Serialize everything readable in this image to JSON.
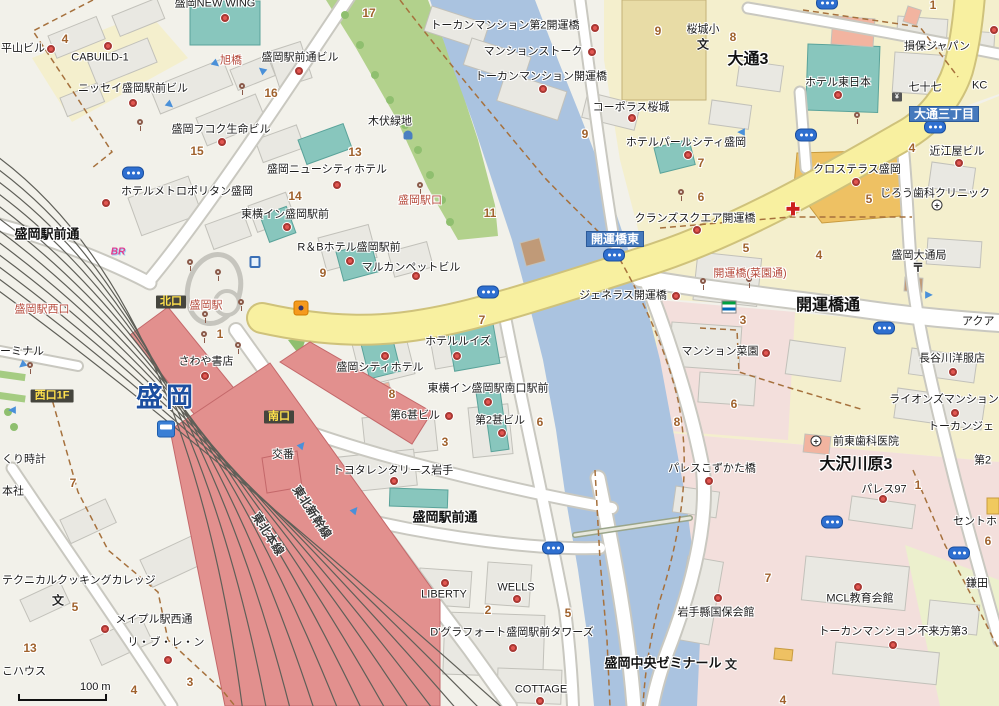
{
  "map": {
    "scale_label": "100 m",
    "colors": {
      "land": "#f2f1ea",
      "building": "#e9e8e2",
      "building_stroke": "#c2c1ba",
      "road_fill": "#ffffff",
      "road_casing": "#c9c8c0",
      "main_road": "#f8f0a0",
      "main_road_casing": "#d3c579",
      "river": "#aac3e0",
      "park": "#b2d18c",
      "district_yellow": "#f4efcd",
      "district_pink": "#f3dfdc",
      "district_green": "#ecf0cd",
      "teal_building": "#88c6bd",
      "orange_building": "#eec163",
      "salmon_building": "#f2b4a0",
      "school_building": "#e8dca6",
      "station_red": "#e2908e",
      "badge_dark_bg": "#45453d",
      "badge_dark_text": "#ffe14d",
      "badge_blue_bg": "#4579bd",
      "badge_blue_text": "#ffffff",
      "poi_dot": "#e25752",
      "red_label": "#b5493b",
      "number_label": "#a0622d",
      "rail_line": "#5f5f58",
      "boundary_dash": "#a6713d",
      "bus_icon": "#2e6fd0",
      "station_name_blue": "#1d4fa0"
    },
    "labels": [
      {
        "t": "盛岡NEW WING",
        "x": 215,
        "y": 4,
        "c": "b"
      },
      {
        "t": "平山ビル",
        "x": 1,
        "y": 49,
        "c": "b",
        "a": "l"
      },
      {
        "t": "CABUILD-1",
        "x": 100,
        "y": 58,
        "c": "b"
      },
      {
        "t": "ニッセイ盛岡駅前ビル",
        "x": 133,
        "y": 89,
        "c": "b"
      },
      {
        "t": "盛岡フコク生命ビル",
        "x": 221,
        "y": 130,
        "c": "b"
      },
      {
        "t": "盛岡駅前通ビル",
        "x": 300,
        "y": 58,
        "c": "b"
      },
      {
        "t": "旭橋",
        "x": 231,
        "y": 61,
        "c": "rb"
      },
      {
        "t": "ホテルメトロポリタン盛岡",
        "x": 187,
        "y": 192,
        "c": "b"
      },
      {
        "t": "東横イン盛岡駅前",
        "x": 285,
        "y": 215,
        "c": "b"
      },
      {
        "t": "盛岡ニューシティホテル",
        "x": 327,
        "y": 170,
        "c": "b"
      },
      {
        "t": "R＆Bホテル盛岡駅前",
        "x": 349,
        "y": 248,
        "c": "b"
      },
      {
        "t": "マルカンペットビル",
        "x": 411,
        "y": 268,
        "c": "b"
      },
      {
        "t": "ホテルルイズ",
        "x": 458,
        "y": 342,
        "c": "b"
      },
      {
        "t": "盛岡シティホテル",
        "x": 380,
        "y": 368,
        "c": "b"
      },
      {
        "t": "東横イン盛岡駅南口駅前",
        "x": 488,
        "y": 389,
        "c": "b"
      },
      {
        "t": "第6甚ビル",
        "x": 415,
        "y": 416,
        "c": "b"
      },
      {
        "t": "第2甚ビル",
        "x": 500,
        "y": 421,
        "c": "b"
      },
      {
        "t": "トヨタレンタリース岩手",
        "x": 393,
        "y": 471,
        "c": "b"
      },
      {
        "t": "さわや書店",
        "x": 206,
        "y": 362,
        "c": "b"
      },
      {
        "t": "交番",
        "x": 283,
        "y": 455,
        "c": "b"
      },
      {
        "t": "木伏緑地",
        "x": 390,
        "y": 122,
        "c": "b"
      },
      {
        "t": "盛岡駅口",
        "x": 420,
        "y": 201,
        "c": "rb"
      },
      {
        "t": "盛岡駅西口",
        "x": 42,
        "y": 310,
        "c": "rb"
      },
      {
        "t": "盛岡駅",
        "x": 206,
        "y": 306,
        "c": "rb"
      },
      {
        "t": "ーミナル",
        "x": 0,
        "y": 352,
        "c": "b",
        "a": "l"
      },
      {
        "t": "くり時計",
        "x": 2,
        "y": 460,
        "c": "b",
        "a": "l"
      },
      {
        "t": "本社",
        "x": 2,
        "y": 492,
        "c": "b",
        "a": "l"
      },
      {
        "t": "こハウス",
        "x": 2,
        "y": 672,
        "c": "b",
        "a": "l"
      },
      {
        "t": "テクニカルクッキングカレッジ",
        "x": 2,
        "y": 581,
        "c": "b",
        "a": "l"
      },
      {
        "t": "メイプル駅西通",
        "x": 154,
        "y": 620,
        "c": "b"
      },
      {
        "t": "リ・ブ・レ・ン",
        "x": 166,
        "y": 643,
        "c": "b"
      },
      {
        "t": "LIBERTY",
        "x": 444,
        "y": 595,
        "c": "b"
      },
      {
        "t": "WELLS",
        "x": 516,
        "y": 588,
        "c": "b"
      },
      {
        "t": "D'グラフォート盛岡駅前タワーズ",
        "x": 512,
        "y": 633,
        "c": "b"
      },
      {
        "t": "COTTAGE",
        "x": 541,
        "y": 690,
        "c": "b"
      },
      {
        "t": "トーカンマンション第2開運橋",
        "x": 505,
        "y": 26,
        "c": "b"
      },
      {
        "t": "マンションストーク",
        "x": 533,
        "y": 52,
        "c": "b"
      },
      {
        "t": "トーカンマンション開運橋",
        "x": 541,
        "y": 77,
        "c": "b"
      },
      {
        "t": "コーポラス桜城",
        "x": 631,
        "y": 108,
        "c": "b"
      },
      {
        "t": "ホテルパールシティ盛岡",
        "x": 686,
        "y": 143,
        "c": "b"
      },
      {
        "t": "クランズスクエア開運橋",
        "x": 695,
        "y": 219,
        "c": "b"
      },
      {
        "t": "ジェネラス開運橋",
        "x": 623,
        "y": 296,
        "c": "b"
      },
      {
        "t": "桜城小",
        "x": 703,
        "y": 30,
        "c": "b"
      },
      {
        "t": "ホテル東日本",
        "x": 838,
        "y": 83,
        "c": "b"
      },
      {
        "t": "七十七",
        "x": 925,
        "y": 88,
        "c": "b"
      },
      {
        "t": "損保ジャパン",
        "x": 937,
        "y": 47,
        "c": "b"
      },
      {
        "t": "KC",
        "x": 972,
        "y": 86,
        "c": "b",
        "a": "l"
      },
      {
        "t": "近江屋ビル",
        "x": 957,
        "y": 152,
        "c": "b"
      },
      {
        "t": "クロステラス盛岡",
        "x": 857,
        "y": 170,
        "c": "b"
      },
      {
        "t": "じろう歯科クリニック",
        "x": 935,
        "y": 194,
        "c": "b"
      },
      {
        "t": "盛岡大通局",
        "x": 919,
        "y": 256,
        "c": "b"
      },
      {
        "t": "開運橋(菜園通)",
        "x": 750,
        "y": 274,
        "c": "rb"
      },
      {
        "t": "マンション菜園",
        "x": 720,
        "y": 352,
        "c": "b"
      },
      {
        "t": "長谷川洋服店",
        "x": 952,
        "y": 359,
        "c": "b"
      },
      {
        "t": "ライオンズマンション",
        "x": 944,
        "y": 400,
        "c": "b"
      },
      {
        "t": "トーカンジェ",
        "x": 928,
        "y": 427,
        "c": "b",
        "a": "l"
      },
      {
        "t": "アクア",
        "x": 962,
        "y": 322,
        "c": "b",
        "a": "l"
      },
      {
        "t": "前東歯科医院",
        "x": 866,
        "y": 442,
        "c": "b"
      },
      {
        "t": "パレスこずかた橋",
        "x": 712,
        "y": 469,
        "c": "b"
      },
      {
        "t": "パレス97",
        "x": 884,
        "y": 490,
        "c": "b"
      },
      {
        "t": "セントホ",
        "x": 953,
        "y": 522,
        "c": "b",
        "a": "l"
      },
      {
        "t": "鎌田",
        "x": 966,
        "y": 584,
        "c": "b",
        "a": "l"
      },
      {
        "t": "第2",
        "x": 974,
        "y": 461,
        "c": "b",
        "a": "l"
      },
      {
        "t": "岩手縣国保会館",
        "x": 716,
        "y": 613,
        "c": "b"
      },
      {
        "t": "MCL教育会館",
        "x": 860,
        "y": 599,
        "c": "b"
      },
      {
        "t": "トーカンマンション不来方第3",
        "x": 893,
        "y": 632,
        "c": "b"
      },
      {
        "t": "盛岡駅前通",
        "x": 47,
        "y": 234,
        "c": "sb"
      },
      {
        "t": "盛岡駅前通",
        "x": 445,
        "y": 517,
        "c": "sb"
      },
      {
        "t": "開運橋通",
        "x": 828,
        "y": 306,
        "c": "sbl"
      },
      {
        "t": "大通3",
        "x": 748,
        "y": 60,
        "c": "sbl"
      },
      {
        "t": "大沢川原3",
        "x": 856,
        "y": 465,
        "c": "sbl"
      },
      {
        "t": "盛岡中央ゼミナール",
        "x": 663,
        "y": 663,
        "c": "sb"
      },
      {
        "t": "北口",
        "x": 171,
        "y": 302,
        "c": "bd"
      },
      {
        "t": "南口",
        "x": 279,
        "y": 417,
        "c": "bd"
      },
      {
        "t": "西口1F",
        "x": 52,
        "y": 396,
        "c": "bd"
      },
      {
        "t": "開運橋東",
        "x": 615,
        "y": 239,
        "c": "bb"
      },
      {
        "t": "大通三丁目",
        "x": 944,
        "y": 114,
        "c": "bb"
      },
      {
        "t": "盛岡",
        "x": 166,
        "y": 398,
        "c": "st"
      },
      {
        "t": "東北新幹線",
        "x": 312,
        "y": 512,
        "c": "rail",
        "r": 57
      },
      {
        "t": "東北本線",
        "x": 268,
        "y": 534,
        "c": "rail",
        "r": 57
      },
      {
        "t": "4",
        "x": 65,
        "y": 39,
        "c": "n"
      },
      {
        "t": "16",
        "x": 271,
        "y": 93,
        "c": "n"
      },
      {
        "t": "15",
        "x": 197,
        "y": 151,
        "c": "n"
      },
      {
        "t": "14",
        "x": 295,
        "y": 196,
        "c": "n"
      },
      {
        "t": "17",
        "x": 369,
        "y": 13,
        "c": "n"
      },
      {
        "t": "13",
        "x": 355,
        "y": 152,
        "c": "n"
      },
      {
        "t": "9",
        "x": 585,
        "y": 134,
        "c": "n"
      },
      {
        "t": "9",
        "x": 658,
        "y": 31,
        "c": "n"
      },
      {
        "t": "11",
        "x": 490,
        "y": 213,
        "c": "n"
      },
      {
        "t": "9",
        "x": 323,
        "y": 273,
        "c": "n"
      },
      {
        "t": "1",
        "x": 220,
        "y": 334,
        "c": "n"
      },
      {
        "t": "8",
        "x": 733,
        "y": 37,
        "c": "n"
      },
      {
        "t": "7",
        "x": 701,
        "y": 163,
        "c": "n"
      },
      {
        "t": "6",
        "x": 701,
        "y": 197,
        "c": "n"
      },
      {
        "t": "5",
        "x": 746,
        "y": 248,
        "c": "n"
      },
      {
        "t": "4",
        "x": 819,
        "y": 255,
        "c": "n"
      },
      {
        "t": "3",
        "x": 743,
        "y": 320,
        "c": "n"
      },
      {
        "t": "4",
        "x": 912,
        "y": 148,
        "c": "n"
      },
      {
        "t": "5",
        "x": 869,
        "y": 199,
        "c": "n"
      },
      {
        "t": "1",
        "x": 933,
        "y": 5,
        "c": "n"
      },
      {
        "t": "7",
        "x": 482,
        "y": 320,
        "c": "n"
      },
      {
        "t": "8",
        "x": 392,
        "y": 394,
        "c": "n"
      },
      {
        "t": "6",
        "x": 540,
        "y": 422,
        "c": "n"
      },
      {
        "t": "3",
        "x": 445,
        "y": 442,
        "c": "n"
      },
      {
        "t": "2",
        "x": 488,
        "y": 610,
        "c": "n"
      },
      {
        "t": "5",
        "x": 568,
        "y": 613,
        "c": "n"
      },
      {
        "t": "7",
        "x": 73,
        "y": 483,
        "c": "n"
      },
      {
        "t": "5",
        "x": 75,
        "y": 607,
        "c": "n"
      },
      {
        "t": "13",
        "x": 30,
        "y": 648,
        "c": "n"
      },
      {
        "t": "4",
        "x": 134,
        "y": 690,
        "c": "n"
      },
      {
        "t": "3",
        "x": 190,
        "y": 682,
        "c": "n"
      },
      {
        "t": "8",
        "x": 677,
        "y": 422,
        "c": "n"
      },
      {
        "t": "6",
        "x": 734,
        "y": 404,
        "c": "n"
      },
      {
        "t": "7",
        "x": 768,
        "y": 578,
        "c": "n"
      },
      {
        "t": "4",
        "x": 783,
        "y": 700,
        "c": "n"
      },
      {
        "t": "1",
        "x": 918,
        "y": 485,
        "c": "n"
      },
      {
        "t": "6",
        "x": 988,
        "y": 541,
        "c": "n"
      }
    ],
    "poi_dots": [
      [
        51,
        49
      ],
      [
        108,
        46
      ],
      [
        133,
        103
      ],
      [
        222,
        142
      ],
      [
        225,
        18
      ],
      [
        299,
        71
      ],
      [
        106,
        203
      ],
      [
        287,
        227
      ],
      [
        337,
        185
      ],
      [
        350,
        261
      ],
      [
        416,
        276
      ],
      [
        457,
        356
      ],
      [
        385,
        356
      ],
      [
        488,
        402
      ],
      [
        449,
        416
      ],
      [
        502,
        433
      ],
      [
        394,
        481
      ],
      [
        205,
        376
      ],
      [
        445,
        583
      ],
      [
        517,
        599
      ],
      [
        513,
        648
      ],
      [
        540,
        701
      ],
      [
        105,
        629
      ],
      [
        168,
        660
      ],
      [
        595,
        28
      ],
      [
        592,
        52
      ],
      [
        543,
        89
      ],
      [
        632,
        118
      ],
      [
        688,
        155
      ],
      [
        697,
        230
      ],
      [
        676,
        296
      ],
      [
        838,
        95
      ],
      [
        994,
        30
      ],
      [
        959,
        163
      ],
      [
        856,
        182
      ],
      [
        766,
        353
      ],
      [
        953,
        372
      ],
      [
        955,
        413
      ],
      [
        883,
        499
      ],
      [
        718,
        598
      ],
      [
        858,
        587
      ],
      [
        893,
        645
      ],
      [
        709,
        481
      ]
    ],
    "bus_stops": [
      [
        133,
        173
      ],
      [
        488,
        292
      ],
      [
        614,
        255
      ],
      [
        827,
        3
      ],
      [
        806,
        135
      ],
      [
        935,
        127
      ],
      [
        884,
        328
      ],
      [
        553,
        548
      ],
      [
        832,
        522
      ],
      [
        959,
        553
      ]
    ],
    "signals": [
      [
        420,
        188
      ],
      [
        703,
        284
      ],
      [
        749,
        282
      ],
      [
        190,
        265
      ],
      [
        218,
        275
      ],
      [
        205,
        317
      ],
      [
        241,
        305
      ],
      [
        204,
        337
      ],
      [
        238,
        348
      ],
      [
        140,
        125
      ],
      [
        242,
        89
      ],
      [
        681,
        195
      ],
      [
        857,
        118
      ],
      [
        30,
        368
      ]
    ],
    "arrows": [
      [
        170,
        105,
        40
      ],
      [
        216,
        64,
        40
      ],
      [
        262,
        70,
        220
      ],
      [
        22,
        365,
        140
      ],
      [
        12,
        410,
        180
      ],
      [
        302,
        445,
        310
      ],
      [
        355,
        510,
        310
      ],
      [
        741,
        132,
        180
      ],
      [
        929,
        295,
        0
      ]
    ],
    "icons": [
      {
        "t": "school",
        "x": 703,
        "y": 44,
        "ch": "文"
      },
      {
        "t": "school",
        "x": 58,
        "y": 600,
        "ch": "文"
      },
      {
        "t": "school",
        "x": 731,
        "y": 664,
        "ch": "文"
      },
      {
        "t": "post",
        "x": 918,
        "y": 267,
        "ch": "〒"
      },
      {
        "t": "bank",
        "x": 897,
        "y": 97,
        "ch": "¥"
      },
      {
        "t": "dental",
        "x": 816,
        "y": 441,
        "ch": "+"
      },
      {
        "t": "dental",
        "x": 937,
        "y": 205,
        "ch": "+"
      },
      {
        "t": "redcross",
        "x": 793,
        "y": 210,
        "ch": "✚"
      },
      {
        "t": "fm",
        "x": 729,
        "y": 307
      },
      {
        "t": "br",
        "x": 118,
        "y": 252,
        "ch": "BR"
      },
      {
        "t": "train",
        "x": 166,
        "y": 429
      },
      {
        "t": "fountain",
        "x": 408,
        "y": 135
      },
      {
        "t": "monument",
        "x": 255,
        "y": 262
      },
      {
        "t": "orange",
        "x": 301,
        "y": 308
      }
    ]
  }
}
